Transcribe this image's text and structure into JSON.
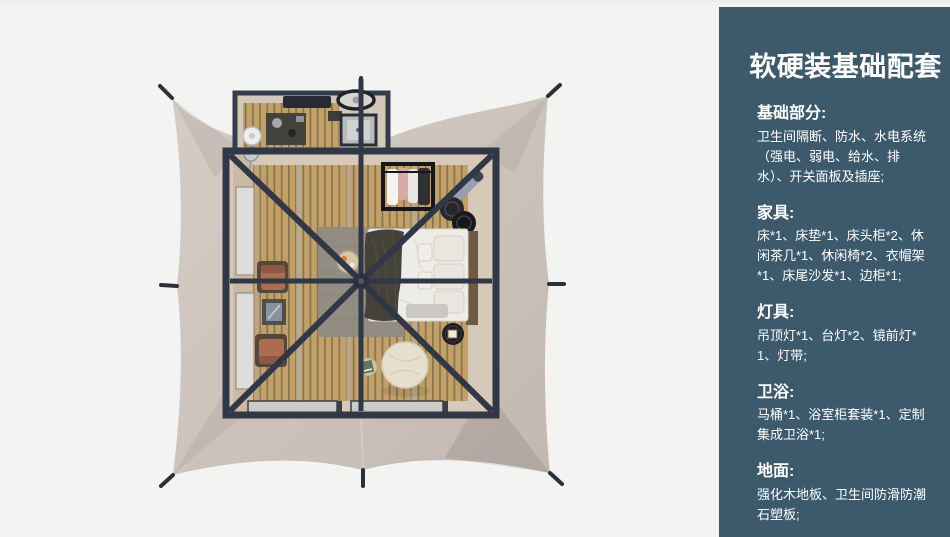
{
  "sidebar": {
    "title": "软硬装基础配套",
    "sections": [
      {
        "heading": "基础部分:",
        "body": "卫生间隔断、防水、水电系统（强电、弱电、给水、排水）、开关面板及插座;"
      },
      {
        "heading": "家具:",
        "body": "床*1、床垫*1、床头柜*2、休闲茶几*1、休闲椅*2、衣帽架*1、床尾沙发*1、边柜*1;"
      },
      {
        "heading": "灯具:",
        "body": "吊顶灯*1、台灯*2、镜前灯*1、灯带;"
      },
      {
        "heading": "卫浴:",
        "body": "马桶*1、浴室柜套装*1、定制集成卫浴*1;"
      },
      {
        "heading": "地面:",
        "body": "强化木地板、卫生间防滑防潮石塑板;"
      }
    ]
  },
  "colors": {
    "page_bg": "#f3f3f2",
    "sidebar_bg": "#3d596c",
    "sidebar_text": "#ffffff",
    "canvas": "#ccc3bb",
    "frame": "#303747",
    "wood": "#c2a066",
    "wood_line": "#564f42",
    "windowp": "#dcdcda",
    "rug": "#938c82",
    "leather": "#ad6c4c",
    "bedding": "#f0eeea",
    "blanket": "#454239",
    "pouf": "#e7dfcd"
  }
}
